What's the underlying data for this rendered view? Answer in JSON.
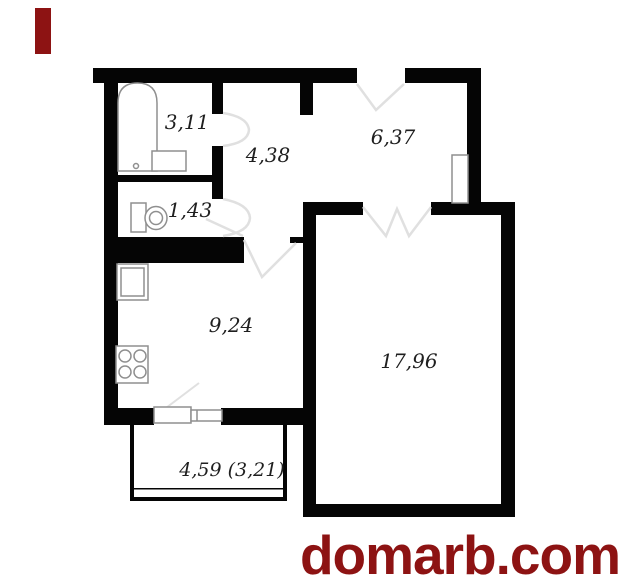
{
  "brand": {
    "site": "domarb.com",
    "color": "#8d1313"
  },
  "floor_plan": {
    "colors": {
      "wall": "#050505",
      "door_swing": "#e0e0e0",
      "fixture": "#8f8f8f",
      "label": "#1f1f1f"
    },
    "rooms": [
      {
        "name": "bathroom",
        "area_label": "3,11"
      },
      {
        "name": "hallway",
        "area_label": "4,38"
      },
      {
        "name": "entrance-hall",
        "area_label": "6,37"
      },
      {
        "name": "toilet",
        "area_label": "1,43"
      },
      {
        "name": "kitchen",
        "area_label": "9,24"
      },
      {
        "name": "living-room",
        "area_label": "17,96"
      },
      {
        "name": "balcony",
        "area_label": "4,59 (3,21)"
      }
    ]
  }
}
